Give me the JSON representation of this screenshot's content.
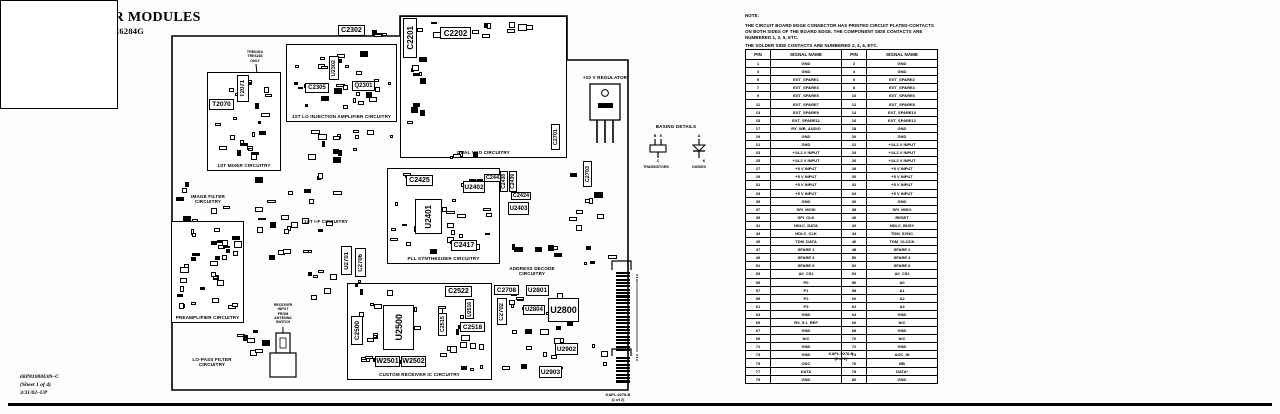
{
  "header": {
    "title": "UHF RECEIVER MODULES",
    "subtitle": "MODELS TRE6281G–TRE6284G"
  },
  "footer": {
    "doc_number": "68P81088E09–C",
    "sheet": "(Sheet 1 of 4)",
    "revision": "3/31/02–UP"
  },
  "notes": {
    "heading": "NOTE:",
    "para1": "THE CIRCUIT BOARD EDGE CONNECTOR HAS PRINTED CIRCUIT PLATED-CONTACTS ON BOTH SIDES OF THE BOARD EDGE. THE COMPONENT SIDE CONTACTS ARE NUMBERED 1, 3, 5, ETC.",
    "para2": "THE SOLDER SIDE CONTACTS ARE NUMBERED 2, 4, 6, ETC.",
    "para3": "SEE THE FOLLOWING TABLE FOR EDGE CONNECTOR PIN NUMBERING/SIGNAL NAME CROSS-REFERENCE."
  },
  "pin_table": {
    "headers": [
      "PIN",
      "SIGNAL NAME",
      "PIN",
      "SIGNAL NAME"
    ],
    "caption_line1": "KAPL-9278-B",
    "caption_line2": "(2 of 2)",
    "rows": [
      [
        "1",
        "GND",
        "2",
        "GND"
      ],
      [
        "3",
        "GND",
        "4",
        "GND"
      ],
      [
        "5",
        "EXT_SPARE1",
        "6",
        "EXT_SPARE2"
      ],
      [
        "7",
        "EXT_SPARE3",
        "8",
        "EXT_SPARE4"
      ],
      [
        "9",
        "EXT_SPARE5",
        "10",
        "EXT_SPARE6"
      ],
      [
        "11",
        "EXT_SPARE7",
        "12",
        "EXT_SPARE8"
      ],
      [
        "13",
        "EXT_SPARE9",
        "14",
        "EXT_SPARE10"
      ],
      [
        "15",
        "EXT_SPARE11",
        "16",
        "EXT_SPARE12"
      ],
      [
        "17",
        "RX_WB_AUDIO",
        "18",
        "GND"
      ],
      [
        "19",
        "GND",
        "20",
        "GND"
      ],
      [
        "21",
        "GND",
        "22",
        "+14.2 V INPUT"
      ],
      [
        "23",
        "+14.2 V INPUT",
        "24",
        "+14.2 V INPUT"
      ],
      [
        "25",
        "+14.2 V INPUT",
        "26",
        "+14.2 V INPUT"
      ],
      [
        "27",
        "+5 V INPUT",
        "28",
        "+5 V INPUT"
      ],
      [
        "29",
        "+5 V INPUT",
        "30",
        "+5 V INPUT"
      ],
      [
        "31",
        "+5 V INPUT",
        "32",
        "+5 V INPUT"
      ],
      [
        "33",
        "+5 V INPUT",
        "34",
        "+5 V INPUT"
      ],
      [
        "35",
        "GND",
        "36",
        "GND"
      ],
      [
        "37",
        "SPI_MOSI",
        "38",
        "SPI_MISO"
      ],
      [
        "39",
        "SPI_CLK",
        "40",
        "RESET"
      ],
      [
        "41",
        "HDLC_DATA",
        "42",
        "HDLC_BUSY"
      ],
      [
        "43",
        "HDLC_CLK",
        "44",
        "TDM_SYNC"
      ],
      [
        "45",
        "TDM_DATA",
        "46",
        "TDM_CLOCK"
      ],
      [
        "47",
        "SPARE 1",
        "48",
        "SPARE 2"
      ],
      [
        "49",
        "SPARE 3",
        "50",
        "SPARE 4"
      ],
      [
        "51",
        "SPARE 5",
        "52",
        "SPARE 6"
      ],
      [
        "53",
        "A0_CS1",
        "54",
        "A0_CS2"
      ],
      [
        "55",
        "P0",
        "56",
        "A0"
      ],
      [
        "57",
        "P1",
        "58",
        "A1"
      ],
      [
        "59",
        "P2",
        "60",
        "A2"
      ],
      [
        "61",
        "P3",
        "62",
        "A3"
      ],
      [
        "63",
        "GND",
        "64",
        "GND"
      ],
      [
        "65",
        "RX_5.1_REF",
        "66",
        "N/C"
      ],
      [
        "67",
        "GND",
        "68",
        "GND"
      ],
      [
        "69",
        "N/C",
        "70",
        "N/C"
      ],
      [
        "71",
        "GND",
        "72",
        "GND"
      ],
      [
        "73",
        "GND",
        "74",
        "AGC_IN"
      ],
      [
        "75",
        "ODC",
        "76",
        "BB"
      ],
      [
        "77",
        "DATA",
        "78",
        "DATA*"
      ],
      [
        "79",
        "GND",
        "80",
        "GND"
      ]
    ]
  },
  "board": {
    "caption_line1": "KAPL-9278-B",
    "caption_line2": "(1 of 2)",
    "big_ic_label": "IC2200",
    "regulator_label": "+10 V REGULATOR",
    "variant_note": [
      "TRE6281/",
      "TRE6283",
      "ONLY"
    ],
    "antenna_note": [
      "RECEIVER",
      "INPUT",
      "FROM",
      "ANTENNA",
      "SWITCH"
    ],
    "basing": {
      "title": "BASING DETAILS",
      "left_label": "TRANSISTORS",
      "right_label": "DIODES",
      "transistor_pins": {
        "top_left": "B",
        "top_right": "E",
        "bottom": "C"
      },
      "diode_pins": {
        "top": "A",
        "bottom": "K"
      }
    },
    "sections": [
      {
        "id": "mixer",
        "label": "1ST MIXER CIRCUITRY",
        "box": true,
        "x": 207,
        "y": 72,
        "w": 74,
        "h": 99
      },
      {
        "id": "lo-injection",
        "label": "1ST LO INJECTION AMPLIFIER CIRCUITRY",
        "box": true,
        "x": 286,
        "y": 44,
        "w": 111,
        "h": 78
      },
      {
        "id": "dual-vco",
        "label": "DUAL VCO CIRCUITRY",
        "box": true,
        "x": 400,
        "y": 16,
        "w": 167,
        "h": 142
      },
      {
        "id": "pll",
        "label": "PLL SYNTHESIZER CIRCUITRY",
        "box": true,
        "x": 387,
        "y": 168,
        "w": 113,
        "h": 96
      },
      {
        "id": "preamp",
        "label": "PREAMPLIFIER CIRCUITRY",
        "box": true,
        "x": 171,
        "y": 221,
        "w": 73,
        "h": 102
      },
      {
        "id": "custom-rx",
        "label": "CUSTOM RECEIVER IC CIRCUITRY",
        "box": true,
        "x": 347,
        "y": 283,
        "w": 145,
        "h": 97
      },
      {
        "id": "image-filter",
        "label": "IMAGE FILTER\nCIRCUITRY",
        "box": false,
        "x": 184,
        "y": 194,
        "w": 48,
        "h": 12
      },
      {
        "id": "first-if",
        "label": "1ST I-F CIRCUITRY",
        "box": false,
        "x": 298,
        "y": 219,
        "w": 56,
        "h": 7
      },
      {
        "id": "lo-pass",
        "label": "LO-PASS FILTER\nCIRCUITRY",
        "box": false,
        "x": 188,
        "y": 357,
        "w": 48,
        "h": 12
      },
      {
        "id": "addr-decode",
        "label": "ADDRESS DECODE\nCIRCUITRY",
        "box": false,
        "x": 506,
        "y": 266,
        "w": 52,
        "h": 12
      }
    ],
    "components": [
      {
        "t": "C2302",
        "x": 338,
        "y": 25,
        "w": 27,
        "h": 11,
        "fs": 7
      },
      {
        "t": "C2201",
        "x": 403,
        "y": 18,
        "w": 14,
        "h": 40,
        "v": 1,
        "fs": 8
      },
      {
        "t": "C2202",
        "x": 440,
        "y": 27,
        "w": 31,
        "h": 12,
        "fs": 8
      },
      {
        "t": "C2701",
        "x": 551,
        "y": 124,
        "w": 9,
        "h": 26,
        "v": 1,
        "fs": 5.5
      },
      {
        "t": "C2703",
        "x": 583,
        "y": 161,
        "w": 9,
        "h": 26,
        "v": 1,
        "fs": 5.5
      },
      {
        "t": "T2071",
        "x": 237,
        "y": 75,
        "w": 12,
        "h": 27,
        "v": 1,
        "fs": 6
      },
      {
        "t": "T2070",
        "x": 209,
        "y": 99,
        "w": 25,
        "h": 11,
        "fs": 6.5
      },
      {
        "t": "C2305",
        "x": 305,
        "y": 83,
        "w": 24,
        "h": 10,
        "fs": 6
      },
      {
        "t": "Q2301",
        "x": 352,
        "y": 81,
        "w": 23,
        "h": 10,
        "fs": 6
      },
      {
        "t": "U2302",
        "x": 329,
        "y": 56,
        "w": 10,
        "h": 24,
        "v": 1,
        "fs": 5.5
      },
      {
        "t": "C2425",
        "x": 406,
        "y": 175,
        "w": 27,
        "h": 11,
        "fs": 7
      },
      {
        "t": "U2402",
        "x": 463,
        "y": 181,
        "w": 22,
        "h": 12,
        "fs": 6.5
      },
      {
        "t": "C2441",
        "x": 484,
        "y": 174,
        "w": 20,
        "h": 8,
        "fs": 5.5
      },
      {
        "t": "C2438",
        "x": 500,
        "y": 171,
        "w": 8,
        "h": 21,
        "v": 1,
        "fs": 5
      },
      {
        "t": "C2439",
        "x": 509,
        "y": 171,
        "w": 8,
        "h": 21,
        "v": 1,
        "fs": 5
      },
      {
        "t": "C2424",
        "x": 511,
        "y": 192,
        "w": 20,
        "h": 8,
        "fs": 5.5
      },
      {
        "t": "U2403",
        "x": 508,
        "y": 202,
        "w": 21,
        "h": 13,
        "fs": 6
      },
      {
        "t": "U2401",
        "x": 415,
        "y": 199,
        "w": 27,
        "h": 35,
        "v": 1,
        "fs": 8
      },
      {
        "t": "C2417",
        "x": 451,
        "y": 240,
        "w": 26,
        "h": 11,
        "fs": 7
      },
      {
        "t": "U2701",
        "x": 341,
        "y": 246,
        "w": 11,
        "h": 29,
        "v": 1,
        "fs": 6
      },
      {
        "t": "C2706",
        "x": 355,
        "y": 248,
        "w": 11,
        "h": 29,
        "v": 1,
        "fs": 6
      },
      {
        "t": "C2522",
        "x": 445,
        "y": 286,
        "w": 27,
        "h": 11,
        "fs": 7
      },
      {
        "t": "C2708",
        "x": 494,
        "y": 285,
        "w": 25,
        "h": 10,
        "fs": 6.5
      },
      {
        "t": "C2702",
        "x": 497,
        "y": 298,
        "w": 10,
        "h": 27,
        "v": 1,
        "fs": 6
      },
      {
        "t": "U2801",
        "x": 526,
        "y": 285,
        "w": 23,
        "h": 11,
        "fs": 6.5
      },
      {
        "t": "U2804",
        "x": 523,
        "y": 305,
        "w": 22,
        "h": 10,
        "fs": 6
      },
      {
        "t": "U2800",
        "x": 548,
        "y": 298,
        "w": 31,
        "h": 24,
        "fs": 9
      },
      {
        "t": "U2902",
        "x": 555,
        "y": 343,
        "w": 23,
        "h": 12,
        "fs": 6.5
      },
      {
        "t": "U2903",
        "x": 539,
        "y": 366,
        "w": 23,
        "h": 12,
        "fs": 6.5
      },
      {
        "t": "C2518",
        "x": 460,
        "y": 322,
        "w": 25,
        "h": 10,
        "fs": 6.5
      },
      {
        "t": "C2515",
        "x": 438,
        "y": 313,
        "w": 9,
        "h": 23,
        "v": 1,
        "fs": 5.5
      },
      {
        "t": "U2516",
        "x": 465,
        "y": 299,
        "w": 9,
        "h": 20,
        "v": 1,
        "fs": 5
      },
      {
        "t": "U2500",
        "x": 383,
        "y": 305,
        "w": 31,
        "h": 45,
        "v": 1,
        "fs": 9
      },
      {
        "t": "C2500",
        "x": 351,
        "y": 316,
        "w": 12,
        "h": 29,
        "v": 1,
        "fs": 6.5
      },
      {
        "t": "W2501",
        "x": 375,
        "y": 356,
        "w": 25,
        "h": 11,
        "fs": 7
      },
      {
        "t": "W2502",
        "x": 401,
        "y": 356,
        "w": 25,
        "h": 11,
        "fs": 7
      }
    ]
  }
}
